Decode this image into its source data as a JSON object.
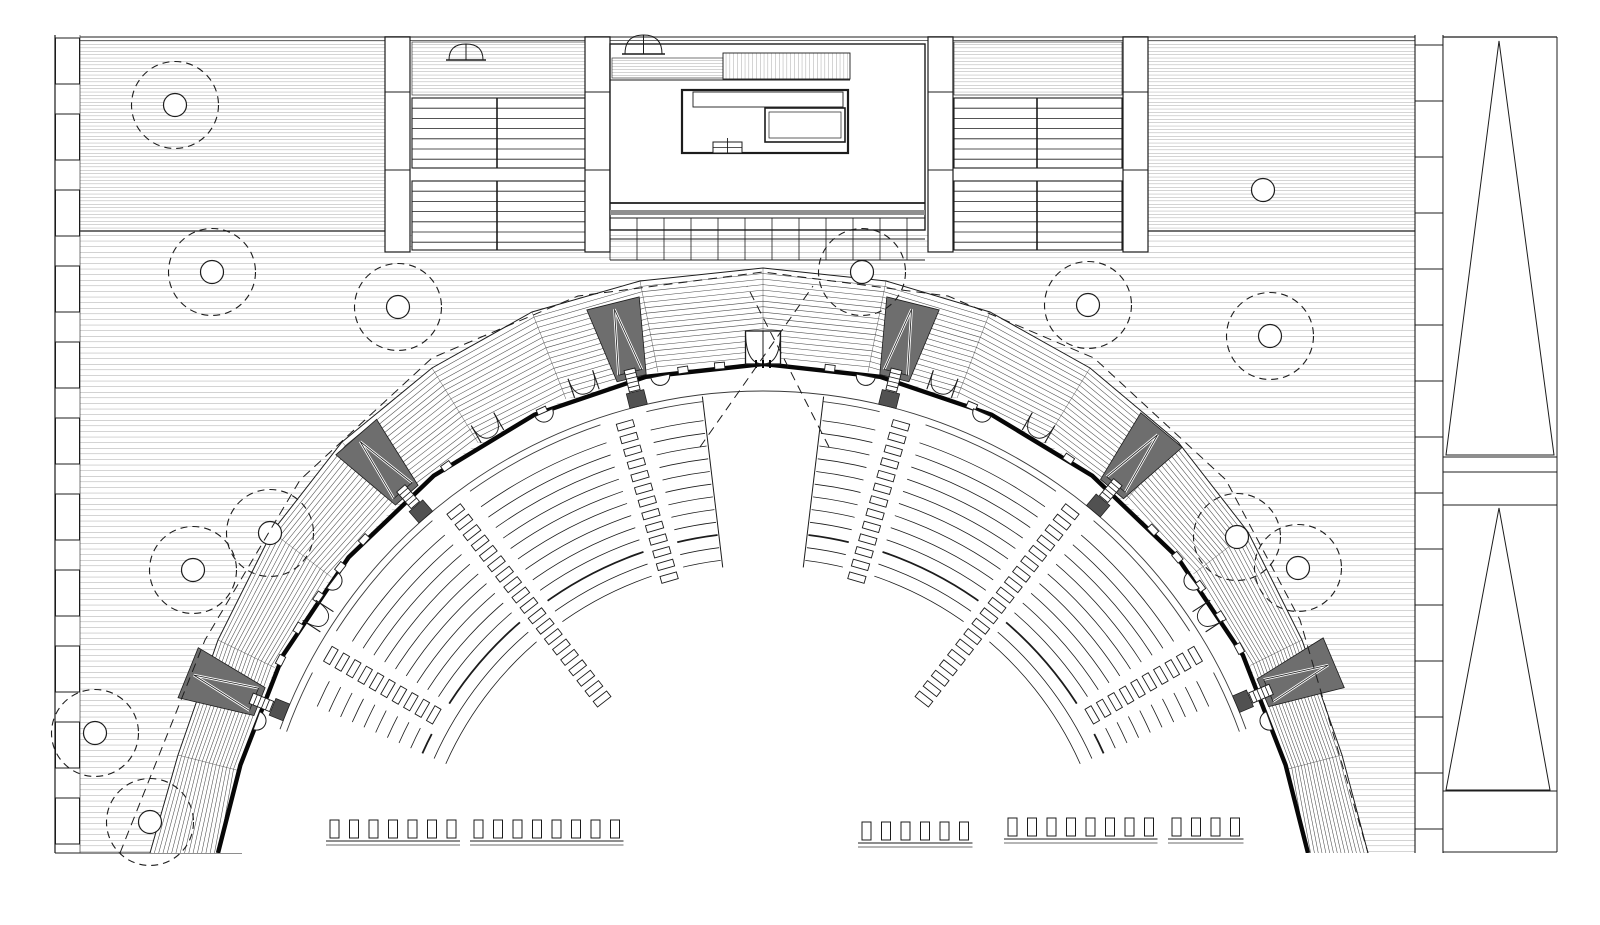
{
  "canvas": {
    "w": 1600,
    "h": 925
  },
  "colors": {
    "paper": "#ffffff",
    "line": "#1c1c1c",
    "thin": "#3a3a3a",
    "hatch": "#6f6f6f",
    "berm_hatch": "#4a4a4a",
    "rim": "#070707",
    "dark_fill": "#6e6e6e",
    "darker_fill": "#515151",
    "gray_band": "#8f8f8f",
    "white": "#ffffff"
  },
  "frame": {
    "top_line_y": 37,
    "top_line2_y": 40.5,
    "top_line_x0": 80,
    "top_line_x1": 1443,
    "band_bottom_y": 231,
    "band_bottom_segs": [
      [
        55,
        385
      ],
      [
        1147,
        1415
      ]
    ],
    "bottom_line": {
      "y": 853,
      "x0": 55,
      "x1": 242
    },
    "clip_bottom": 853
  },
  "deck": {
    "top_band": {
      "rects": [
        [
          80,
          41,
          305,
          190
        ],
        [
          1147,
          41,
          268,
          190
        ]
      ],
      "pitch": 3.4
    },
    "plaza": {
      "rect": [
        80,
        231,
        1335,
        622
      ],
      "pitch": 5.6
    }
  },
  "left_wall": {
    "x": 55,
    "x2": 80,
    "top": 35,
    "bottom": 853,
    "block_w": 24,
    "block_h": 46,
    "pitch": 76
  },
  "right_wall": {
    "x0": 1415,
    "x1": 1443,
    "top": 35,
    "bottom": 853,
    "pitch": 56
  },
  "ramp_strip": {
    "x0": 1443,
    "x1": 1557,
    "top": 37,
    "bottom": 852,
    "hlines": [
      457,
      472,
      505,
      791,
      852
    ],
    "triangles": [
      {
        "apex": [
          1499,
          41
        ],
        "b1": [
          1446,
          455
        ],
        "b2": [
          1554,
          455
        ]
      },
      {
        "apex": [
          1499,
          508
        ],
        "b1": [
          1446,
          790
        ],
        "b2": [
          1550,
          790
        ]
      }
    ]
  },
  "stair_blocks": [
    {
      "piers": [
        [
          385,
          37,
          25,
          215
        ],
        [
          585,
          37,
          25,
          215
        ]
      ],
      "x0": 412,
      "x1": 585,
      "rail_x": 497,
      "deck": [
        42,
        95
      ],
      "flight1": [
        98,
        168
      ],
      "landing": [
        168,
        181
      ],
      "flight2": [
        181,
        250
      ],
      "tread_pitch": 10.2,
      "pier_divs": [
        92,
        170
      ]
    },
    {
      "piers": [
        [
          928,
          37,
          25,
          215
        ],
        [
          1123,
          37,
          25,
          215
        ]
      ],
      "x0": 954,
      "x1": 1122,
      "rail_x": 1037,
      "deck": [
        42,
        95
      ],
      "flight1": [
        98,
        168
      ],
      "landing": [
        168,
        181
      ],
      "flight2": [
        181,
        250
      ],
      "tread_pitch": 10.2,
      "pier_divs": [
        92,
        170
      ]
    }
  ],
  "building": {
    "x0": 610,
    "x1": 925,
    "y0": 44,
    "y1": 230,
    "fans": [
      {
        "x": 625,
        "y": 54,
        "w": 37,
        "h": 19
      },
      {
        "x": 449,
        "y": 60,
        "w": 34,
        "h": 16
      }
    ],
    "hatch_strip": {
      "x0": 612,
      "x1": 723,
      "y0": 58,
      "y1": 78,
      "pitch": 3
    },
    "stair_strip": {
      "x0": 723,
      "x1": 850,
      "y0": 53,
      "y1": 79,
      "pitch": 3.8
    },
    "under_line_y": 80,
    "room": {
      "x0": 682,
      "y0": 90,
      "w": 166,
      "h": 63
    },
    "shelf": {
      "x0": 693,
      "y0": 92,
      "w": 150,
      "h": 15
    },
    "table": {
      "x0": 765,
      "y0": 108,
      "w": 80,
      "h": 34,
      "inset": 4
    },
    "box": {
      "x0": 713,
      "y0": 142,
      "w": 29,
      "h": 11
    },
    "bottom_line_y": 203,
    "gray_band": {
      "x0": 610,
      "y0": 210,
      "w": 315,
      "h": 5
    },
    "grid": {
      "x0": 610,
      "x1": 925,
      "rows": [
        218,
        239,
        260
      ],
      "col_pitch": 27
    }
  },
  "trees": {
    "r": 43.5,
    "cr": 11.5,
    "dash": [
      7,
      5
    ],
    "big": [
      [
        175,
        105
      ],
      [
        212,
        272
      ],
      [
        398,
        307
      ],
      [
        862,
        272
      ],
      [
        1088,
        305
      ],
      [
        1270,
        336
      ],
      [
        270,
        533
      ],
      [
        193,
        570
      ],
      [
        95,
        733
      ],
      [
        150,
        822
      ],
      [
        1237,
        537
      ],
      [
        1298,
        568
      ]
    ],
    "small": [
      [
        1263,
        190
      ]
    ]
  },
  "amphi": {
    "cx": 763,
    "cy": 905,
    "rim_r": 541,
    "rim_angles": [
      15,
      27.5,
      40,
      52.5,
      65,
      77.5,
      90,
      102.5,
      115,
      127.5,
      140,
      152.5,
      165
    ],
    "rim_end_pts": [
      [
        218,
        853
      ],
      [
        1308,
        853
      ]
    ],
    "walk_r": [
      514,
      507
    ],
    "walk_span": [
      20,
      160
    ],
    "rows": {
      "outer": 488,
      "pitch": 12.8,
      "count": 12,
      "spans": [
        [
          24,
          83
        ],
        [
          97,
          156
        ]
      ],
      "thick_idx": 9
    },
    "aisles": [
      {
        "a": 150,
        "inner": 380
      },
      {
        "a": 128,
        "inner": 258
      },
      {
        "a": 106,
        "inner": 330
      },
      {
        "a": 74,
        "inner": 330
      },
      {
        "a": 52,
        "inner": 258
      },
      {
        "a": 30,
        "inner": 380
      }
    ],
    "aisle_half_deg": 2.7,
    "step_w": 17,
    "step_h": 7,
    "step_pitch": 13.2,
    "step_outer": 499,
    "void": {
      "a0": 83.2,
      "a1": 96.8,
      "r0": 340,
      "r1": 512
    },
    "berm": {
      "outer": [
        [
          150,
          853
        ],
        [
          178,
          755
        ],
        [
          218,
          640
        ],
        [
          272,
          532
        ],
        [
          342,
          442
        ],
        [
          432,
          368
        ],
        [
          532,
          312
        ],
        [
          640,
          281
        ],
        [
          763,
          268
        ],
        [
          886,
          281
        ],
        [
          990,
          312
        ],
        [
          1090,
          368
        ],
        [
          1178,
          442
        ],
        [
          1248,
          532
        ],
        [
          1302,
          640
        ],
        [
          1342,
          755
        ],
        [
          1368,
          853
        ]
      ],
      "contours": 16,
      "inner_r": 543
    },
    "towers": {
      "angles": [
        158,
        131,
        104,
        76,
        50,
        23
      ],
      "inner_r": 543,
      "outer_r": 620,
      "half_w_in": 15,
      "half_w_out": 27
    },
    "gate": {
      "a": 90,
      "w": 35,
      "r0": 541,
      "r1": 574
    },
    "fans_outer": {
      "angles": [
        120,
        109,
        71,
        60
      ],
      "w": 26,
      "r0": 541,
      "r1": 561
    },
    "fans_inner": {
      "angles": [
        147,
        33
      ],
      "w": 24,
      "r0": 520,
      "r1": 541
    },
    "bumps": {
      "angles": [
        160,
        143,
        114,
        101,
        79,
        66,
        37,
        20
      ],
      "r": 9.5
    },
    "posts": {
      "step_deg": 3.9,
      "a0": 20.5,
      "a1": 159.5,
      "w": 10,
      "h": 6.5,
      "skip_tol": 3.4
    },
    "benches": [
      {
        "x": 330,
        "y": 820,
        "n": 7,
        "dx": 19.5
      },
      {
        "x": 474,
        "y": 820,
        "n": 8,
        "dx": 19.5
      },
      {
        "x": 862,
        "y": 822,
        "n": 6,
        "dx": 19.5
      },
      {
        "x": 1008,
        "y": 818,
        "n": 8,
        "dx": 19.5
      },
      {
        "x": 1172,
        "y": 818,
        "n": 4,
        "dx": 19.5
      }
    ],
    "bench_size": [
      9,
      18
    ],
    "bench_band_off": [
      21,
      25
    ]
  },
  "dashed": {
    "canopy": [
      [
        120,
        853
      ],
      [
        205,
        640
      ],
      [
        300,
        480
      ],
      [
        432,
        358
      ],
      [
        578,
        296
      ],
      [
        763,
        272
      ],
      [
        948,
        296
      ],
      [
        1094,
        358
      ],
      [
        1226,
        480
      ],
      [
        1300,
        620
      ],
      [
        1368,
        853
      ]
    ],
    "rays": [
      [
        [
          700,
          447
        ],
        [
          813,
          286
        ]
      ],
      [
        [
          829,
          447
        ],
        [
          747,
          286
        ]
      ]
    ],
    "dash": [
      9,
      6
    ]
  }
}
